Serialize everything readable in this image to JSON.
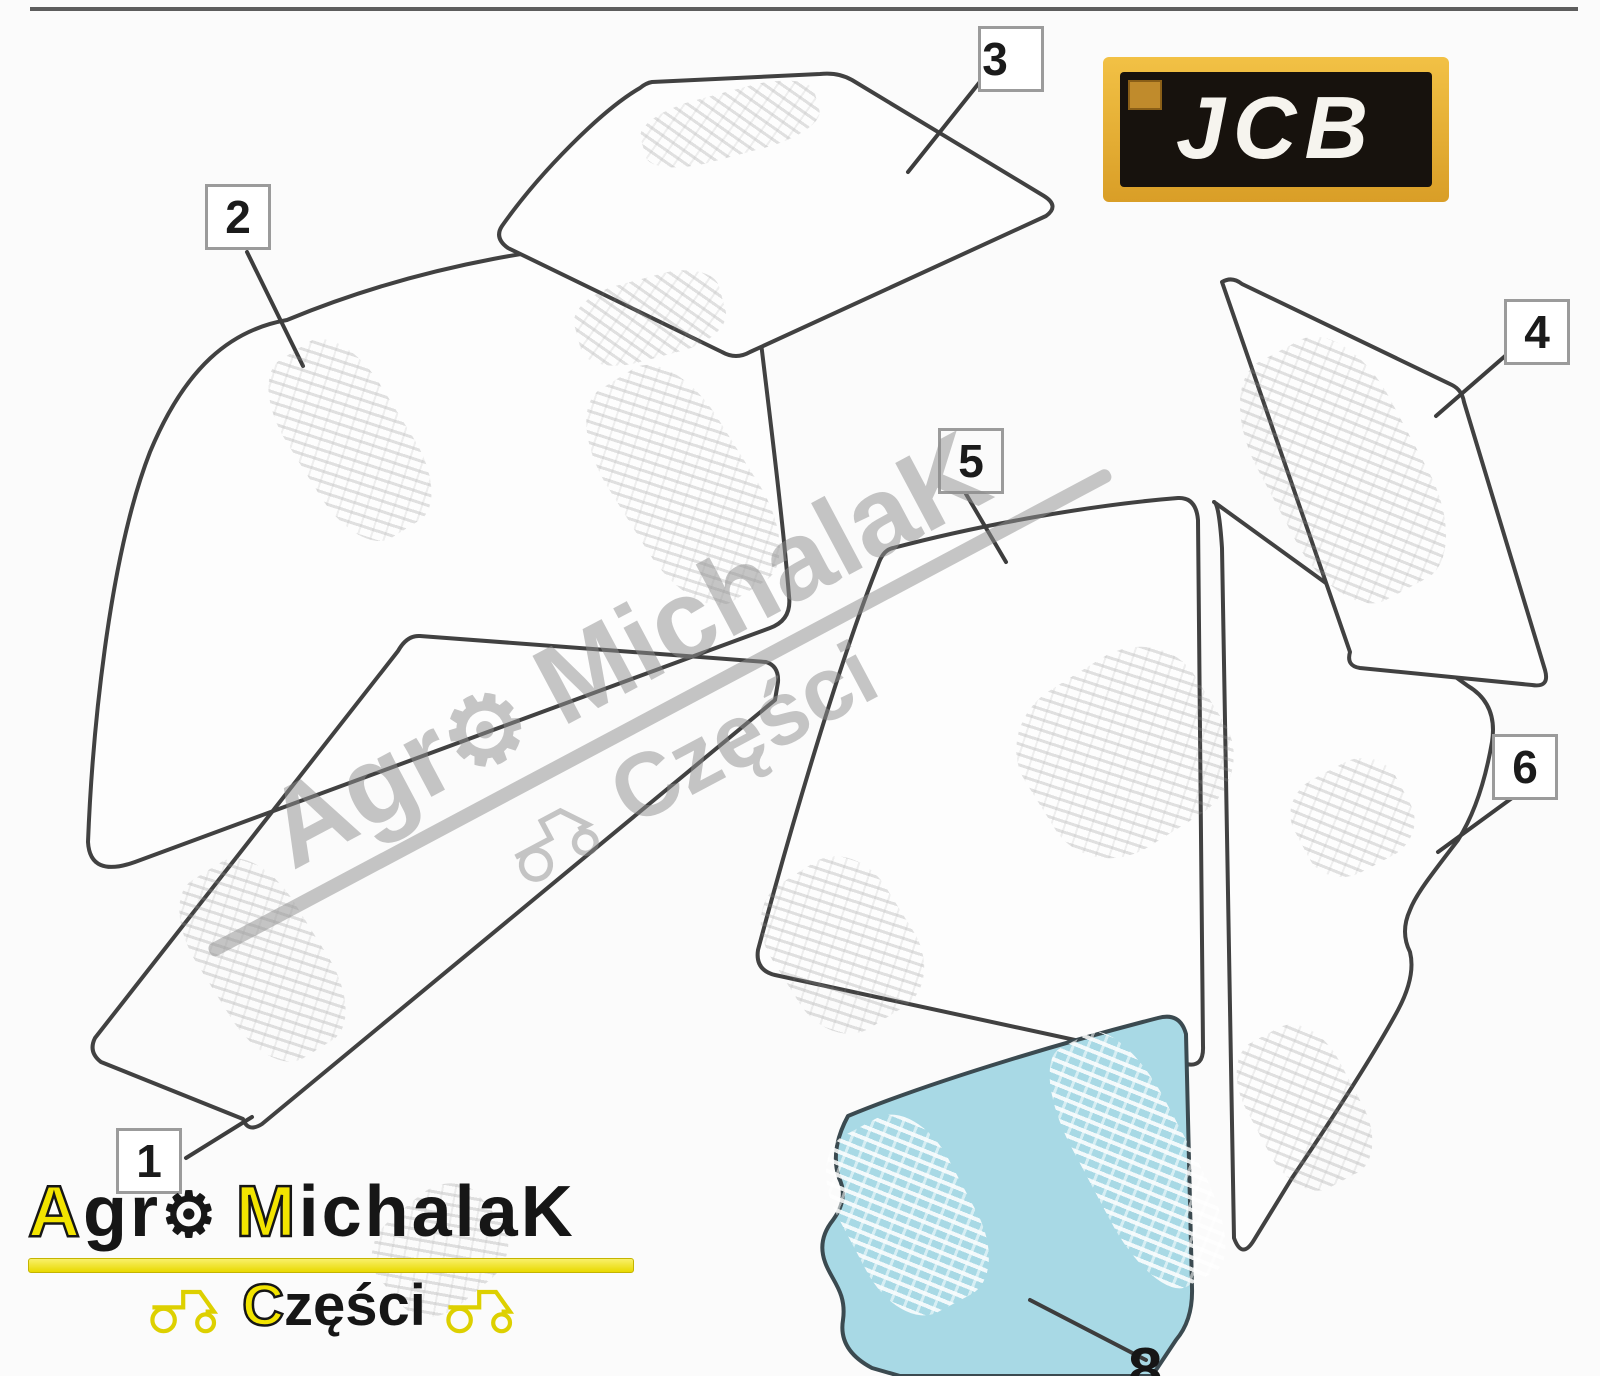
{
  "colors": {
    "jcb_gold": "#E3A62F",
    "logo_yellow": "#F2E400",
    "highlight_blue": "#A8D9E5",
    "watermark_gray": "#9A9A9A",
    "line_art": "#414141"
  },
  "brand": {
    "jcb": "JCB"
  },
  "callouts": [
    {
      "label": "1"
    },
    {
      "label": "2"
    },
    {
      "label": "3"
    },
    {
      "label": "4"
    },
    {
      "label": "5"
    },
    {
      "label": "6"
    }
  ],
  "partial_callout": {
    "label": "8"
  },
  "watermark": {
    "word1_prefix": "Agr",
    "gear": "⚙",
    "word2": "MichalaK",
    "subtitle": "Części"
  },
  "footer_logo": {
    "word1_initial": "A",
    "word1_rest": "gr",
    "gear": "⚙",
    "word2_initial": "M",
    "word2_rest": "ichala",
    "word2_suffix": "K",
    "subtitle_initial": "C",
    "subtitle_rest": "zęści"
  }
}
